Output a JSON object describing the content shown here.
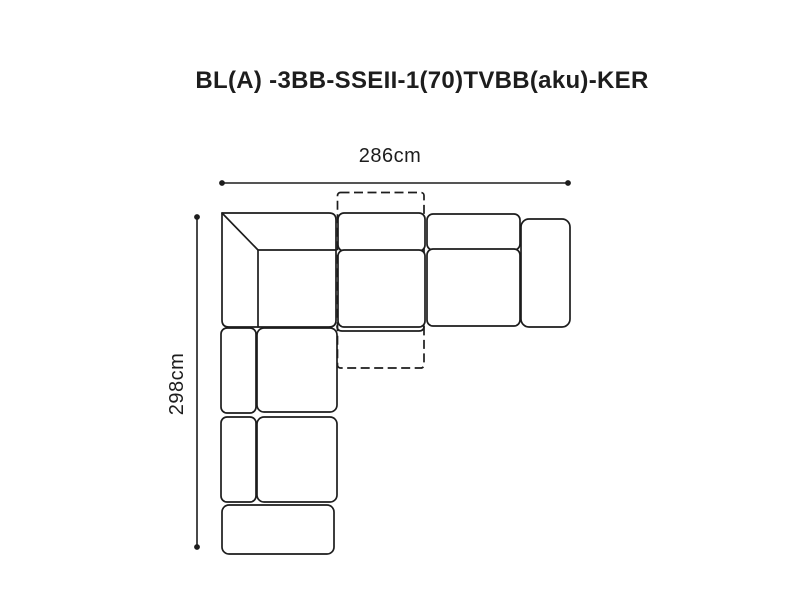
{
  "page": {
    "background_color": "#ffffff",
    "line_color": "#1d1d1d",
    "text_color": "#1d1d1d"
  },
  "diagram": {
    "title": "BL(A) -3BB-SSEII-1(70)TVBB(aku)-KER",
    "width_dimension": "286cm",
    "height_dimension": "298cm"
  }
}
